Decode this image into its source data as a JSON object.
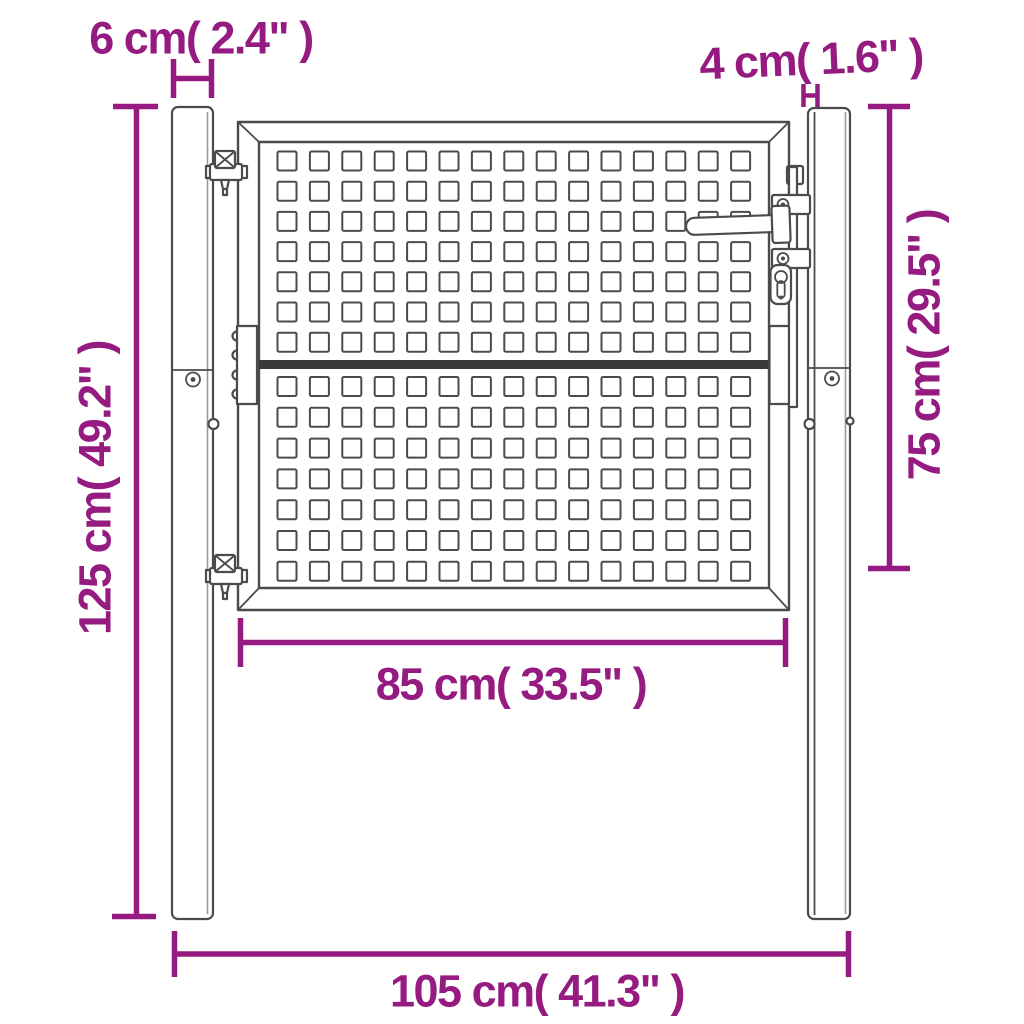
{
  "figure": {
    "kind": "product-dimension-diagram",
    "subject": "perforated garden gate with two square posts"
  },
  "colors": {
    "dimension_accent": "#951b81",
    "line": "#4b4b4b",
    "line_dark": "#3a3a3a",
    "post_shade": "#9a9a9a",
    "background": "#ffffff"
  },
  "gate": {
    "pattern": {
      "columns": 15,
      "rows_per_panel": 7,
      "panels": 2
    }
  },
  "dimensions": {
    "post_width": {
      "label": "6 cm( 2.4\" )",
      "value_cm": 6,
      "value_in": 2.4
    },
    "hinge_gap": {
      "label": "4 cm( 1.6\" )",
      "value_cm": 4,
      "value_in": 1.6
    },
    "post_height": {
      "label": "125 cm( 49.2\" )",
      "value_cm": 125,
      "value_in": 49.2
    },
    "gate_height": {
      "label": "75 cm( 29.5\" )",
      "value_cm": 75,
      "value_in": 29.5
    },
    "gate_width": {
      "label": "85 cm( 33.5\" )",
      "value_cm": 85,
      "value_in": 33.5
    },
    "total_width": {
      "label": "105 cm( 41.3\" )",
      "value_cm": 105,
      "value_in": 41.3
    }
  }
}
